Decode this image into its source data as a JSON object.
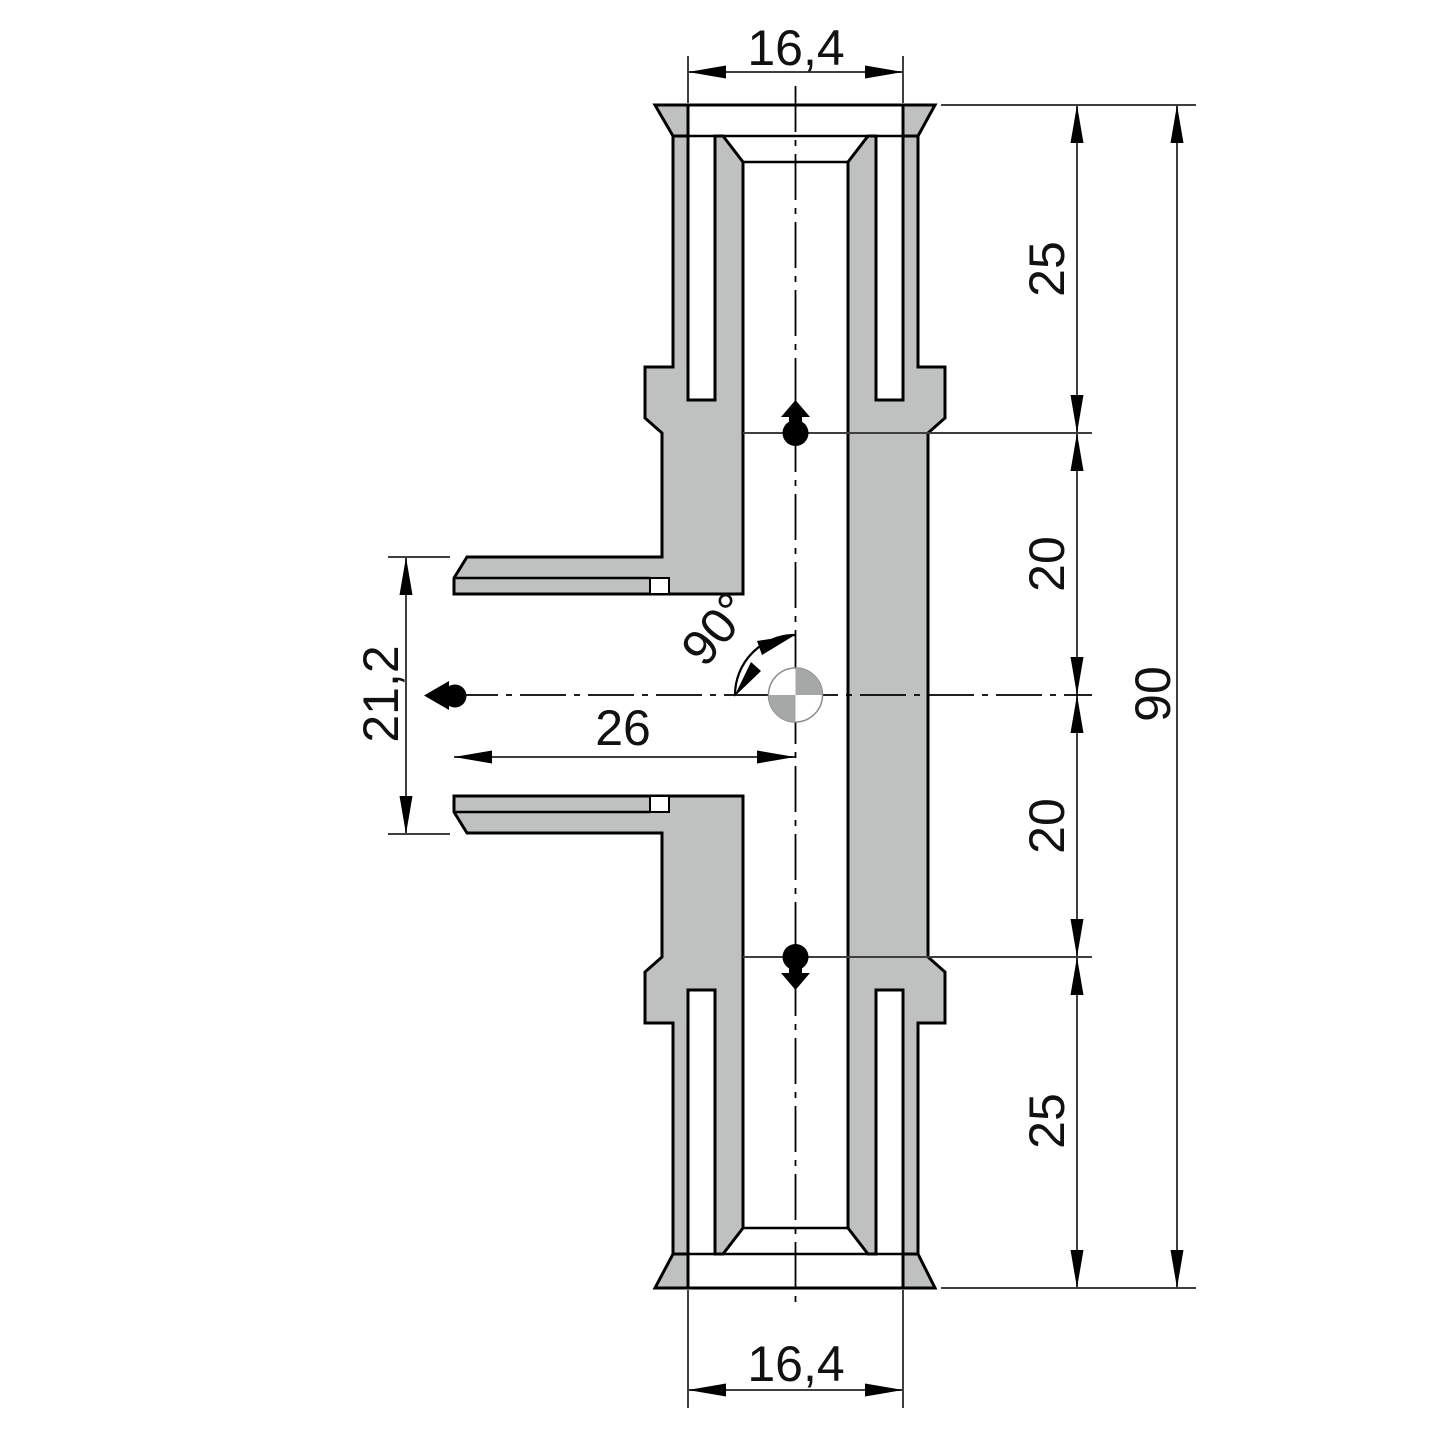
{
  "drawing": {
    "title": "tee-fitting-cross-section",
    "view": "section",
    "dims": {
      "top_socket_width": "16,4",
      "bottom_socket_width": "16,4",
      "branch_outer_width": "21,2",
      "branch_center_depth": "26",
      "branch_angle": "90°",
      "top_port_length": "25",
      "upper_body_length": "20",
      "lower_body_length": "20",
      "bottom_port_length": "25",
      "overall_length": "90"
    },
    "symbols": {
      "connection_points": 3,
      "center_marker": "quadrant-circle"
    },
    "colors": {
      "body_fill": "#bfc0c0",
      "outline": "#000000",
      "dimension_line": "#3f3f3f",
      "marker_gray": "#a6a7a7",
      "background": "#ffffff"
    }
  }
}
